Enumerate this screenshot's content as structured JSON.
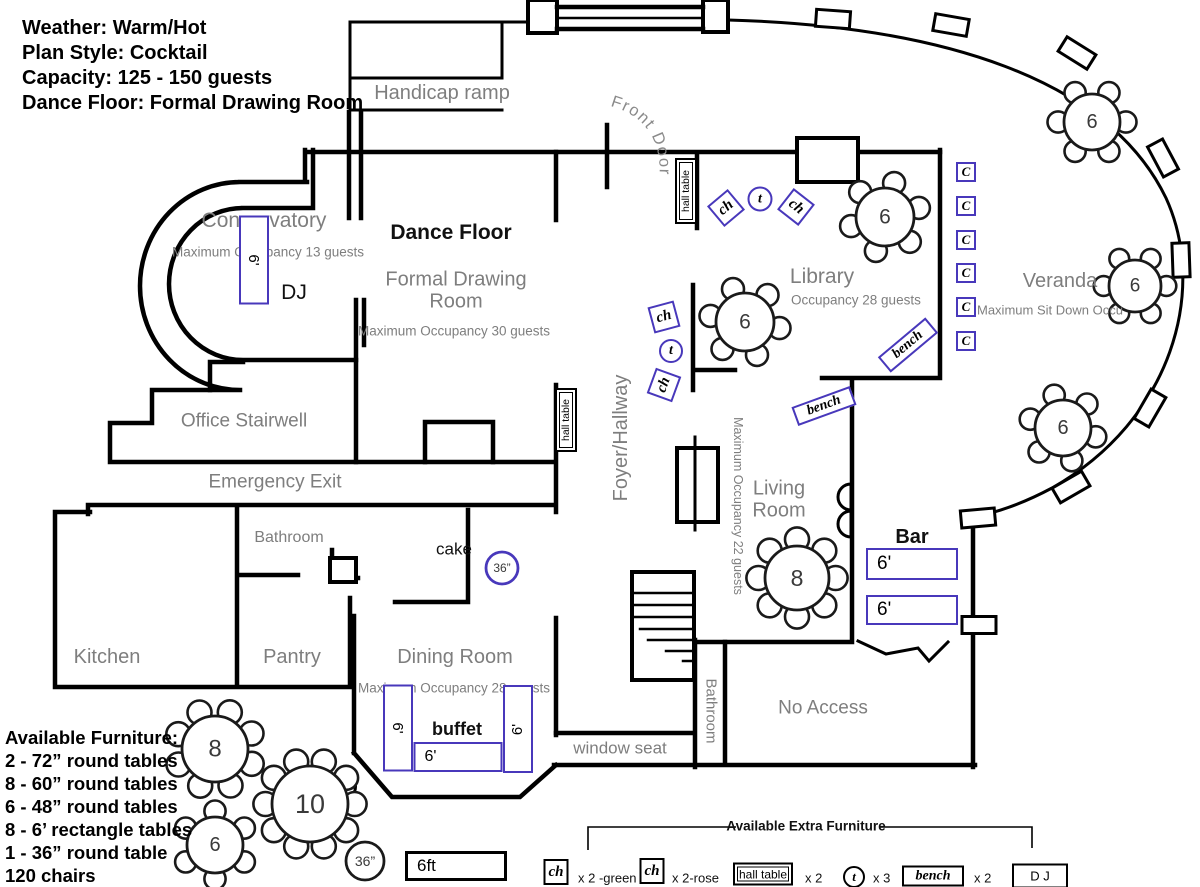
{
  "colors": {
    "furniture_accent": "#4838bb",
    "wall": "#000000",
    "room_label": "#7e7e7e"
  },
  "info_panel": {
    "lines": [
      "Weather: Warm/Hot",
      "Plan Style: Cocktail",
      "Capacity: 125 - 150 guests",
      "Dance Floor: Formal Drawing Room"
    ]
  },
  "available_furniture": {
    "title": "Available Furniture:",
    "items": [
      "2 - 72” round tables",
      "8 - 60” round tables",
      "6 - 48” round tables",
      "8 - 6’ rectangle tables",
      "1 - 36” round table",
      "120 chairs"
    ]
  },
  "front_door": {
    "text": "Front Door"
  },
  "labels": [
    {
      "name": "handicap-ramp-label",
      "text": "Handicap ramp",
      "x": 442,
      "y": 93,
      "size": 20,
      "color": "gray"
    },
    {
      "name": "conservatory-label",
      "text": "Conservatory",
      "x": 264,
      "y": 221,
      "size": 21,
      "color": "gray"
    },
    {
      "name": "conservatory-occupancy",
      "text": "Maximum Occupancy 13 guests",
      "x": 268,
      "y": 252,
      "size": 13.5,
      "color": "gray"
    },
    {
      "name": "dance-floor-label",
      "text": "Dance Floor",
      "x": 451,
      "y": 233,
      "size": 21,
      "color": "black",
      "weight": 600
    },
    {
      "name": "formal-drawing-room-label",
      "text": "Formal Drawing\nRoom",
      "x": 456,
      "y": 291,
      "size": 20,
      "color": "gray",
      "w": 170
    },
    {
      "name": "fdr-occupancy",
      "text": "Maximum Occupancy  30 guests",
      "x": 454,
      "y": 331,
      "size": 13.5,
      "color": "gray"
    },
    {
      "name": "dj-label",
      "text": "DJ",
      "x": 294,
      "y": 293,
      "size": 21,
      "color": "black"
    },
    {
      "name": "office-stairwell-label",
      "text": "Office Stairwell",
      "x": 244,
      "y": 421,
      "size": 19,
      "color": "gray"
    },
    {
      "name": "emergency-exit-label",
      "text": "Emergency Exit",
      "x": 275,
      "y": 482,
      "size": 19,
      "color": "gray"
    },
    {
      "name": "bathroom-label",
      "text": "Bathroom",
      "x": 289,
      "y": 538,
      "size": 16,
      "color": "gray"
    },
    {
      "name": "cake-label",
      "text": "cake",
      "x": 454,
      "y": 549,
      "size": 17,
      "color": "black"
    },
    {
      "name": "kitchen-label",
      "text": "Kitchen",
      "x": 107,
      "y": 657,
      "size": 20,
      "color": "gray"
    },
    {
      "name": "pantry-label",
      "text": "Pantry",
      "x": 292,
      "y": 657,
      "size": 20,
      "color": "gray"
    },
    {
      "name": "dining-room-label",
      "text": "Dining Room",
      "x": 455,
      "y": 657,
      "size": 20,
      "color": "gray"
    },
    {
      "name": "dining-occupancy",
      "text": "Maximum Occupancy 28 guests",
      "x": 454,
      "y": 688,
      "size": 13.5,
      "color": "gray"
    },
    {
      "name": "buffet-label",
      "text": "buffet",
      "x": 457,
      "y": 729,
      "size": 18,
      "color": "black",
      "weight": 600
    },
    {
      "name": "window-seat-label",
      "text": "window seat",
      "x": 620,
      "y": 748,
      "size": 17,
      "color": "gray"
    },
    {
      "name": "foyer-hallway-label",
      "text": "Foyer/Hallway",
      "x": 621,
      "y": 438,
      "size": 20,
      "color": "gray",
      "rot": -90
    },
    {
      "name": "library-label",
      "text": "Library",
      "x": 822,
      "y": 277,
      "size": 21,
      "color": "gray"
    },
    {
      "name": "library-occupancy",
      "text": "Occupancy 28 guests",
      "x": 791,
      "y": 300,
      "size": 13.5,
      "color": "gray",
      "align": "left"
    },
    {
      "name": "living-room-label",
      "text": "Living\nRoom",
      "x": 779,
      "y": 500,
      "size": 20,
      "color": "gray",
      "w": 90
    },
    {
      "name": "living-occupancy",
      "text": "Maximum Occupancy 22 guests",
      "x": 738,
      "y": 506,
      "size": 12.5,
      "color": "gray",
      "rot": 90
    },
    {
      "name": "veranda-label",
      "text": "Veranda",
      "x": 1060,
      "y": 281,
      "size": 20,
      "color": "gray"
    },
    {
      "name": "veranda-occupancy",
      "text": "Maximum Sit Down Occu",
      "x": 977,
      "y": 311,
      "size": 13,
      "color": "gray",
      "align": "left"
    },
    {
      "name": "bathroom-2-label",
      "text": "Bathroom",
      "x": 710,
      "y": 711,
      "size": 15,
      "color": "gray",
      "rot": 90
    },
    {
      "name": "no-access-label",
      "text": "No Access",
      "x": 823,
      "y": 708,
      "size": 19,
      "color": "gray"
    },
    {
      "name": "bar-label",
      "text": "Bar",
      "x": 912,
      "y": 537,
      "size": 20,
      "color": "black",
      "weight": 600
    },
    {
      "name": "extra-furniture-title",
      "text": "Available Extra Furniture",
      "x": 806,
      "y": 826,
      "size": 13.5,
      "color": "black",
      "weight": 600
    },
    {
      "name": "legend-ch-green-qty",
      "text": "x 2 -green",
      "x": 578,
      "y": 879,
      "size": 13,
      "color": "black",
      "align": "left"
    },
    {
      "name": "legend-ch-rose-qty",
      "text": "x 2-rose",
      "x": 672,
      "y": 879,
      "size": 13,
      "color": "black",
      "align": "left"
    },
    {
      "name": "legend-hall-table-qty",
      "text": "x 2",
      "x": 805,
      "y": 879,
      "size": 13,
      "color": "black",
      "align": "left"
    },
    {
      "name": "legend-t-qty",
      "text": "x 3",
      "x": 873,
      "y": 879,
      "size": 13,
      "color": "black",
      "align": "left"
    },
    {
      "name": "legend-bench-qty",
      "text": "x 2",
      "x": 974,
      "y": 879,
      "size": 13,
      "color": "black",
      "align": "left"
    }
  ],
  "furniture": [
    {
      "name": "conservatory-6ft-table",
      "kind": "rect",
      "x": 254,
      "y": 260,
      "w": 30,
      "h": 89,
      "label": "6'",
      "lrot": 90,
      "fs": 15
    },
    {
      "name": "hall-table-1",
      "kind": "hall",
      "x": 686,
      "y": 191,
      "w": 22,
      "h": 66,
      "label": "hall table",
      "lrot": -90,
      "fs": 10.5
    },
    {
      "name": "hall-table-2",
      "kind": "hall",
      "x": 566,
      "y": 420,
      "w": 22,
      "h": 64,
      "label": "hall table",
      "lrot": -90,
      "fs": 10.5
    },
    {
      "name": "chair-ch-1",
      "kind": "rect",
      "x": 726,
      "y": 208,
      "w": 27,
      "h": 27,
      "rot": -40,
      "label": "ch",
      "fs": 15,
      "serif": 1
    },
    {
      "name": "table-t-1",
      "kind": "circle",
      "x": 760,
      "y": 199,
      "w": 25,
      "h": 25,
      "label": "t",
      "fs": 14,
      "serif": 1
    },
    {
      "name": "chair-ch-2",
      "kind": "rect",
      "x": 796,
      "y": 207,
      "w": 27,
      "h": 27,
      "rot": 38,
      "label": "ch",
      "fs": 15,
      "serif": 1
    },
    {
      "name": "chair-ch-3",
      "kind": "rect",
      "x": 664,
      "y": 317,
      "w": 27,
      "h": 27,
      "rot": -15,
      "label": "ch",
      "fs": 15,
      "serif": 1
    },
    {
      "name": "table-t-2",
      "kind": "circle",
      "x": 671,
      "y": 351,
      "w": 24,
      "h": 24,
      "label": "t",
      "fs": 14,
      "serif": 1
    },
    {
      "name": "chair-ch-4",
      "kind": "rect",
      "x": 664,
      "y": 385,
      "w": 27,
      "h": 27,
      "rot": -70,
      "label": "ch",
      "fs": 15,
      "serif": 1
    },
    {
      "name": "chair-c-1",
      "kind": "rect",
      "x": 966,
      "y": 172,
      "w": 20,
      "h": 20,
      "label": "C",
      "fs": 13,
      "serif": 1
    },
    {
      "name": "chair-c-2",
      "kind": "rect",
      "x": 966,
      "y": 206,
      "w": 20,
      "h": 20,
      "label": "C",
      "fs": 13,
      "serif": 1
    },
    {
      "name": "chair-c-3",
      "kind": "rect",
      "x": 966,
      "y": 240,
      "w": 20,
      "h": 20,
      "label": "C",
      "fs": 13,
      "serif": 1
    },
    {
      "name": "chair-c-4",
      "kind": "rect",
      "x": 966,
      "y": 273,
      "w": 20,
      "h": 20,
      "label": "C",
      "fs": 13,
      "serif": 1
    },
    {
      "name": "chair-c-5",
      "kind": "rect",
      "x": 966,
      "y": 307,
      "w": 20,
      "h": 20,
      "label": "C",
      "fs": 13,
      "serif": 1
    },
    {
      "name": "chair-c-6",
      "kind": "rect",
      "x": 966,
      "y": 341,
      "w": 20,
      "h": 20,
      "label": "C",
      "fs": 13,
      "serif": 1
    },
    {
      "name": "bench-1",
      "kind": "rect",
      "x": 908,
      "y": 345,
      "w": 62,
      "h": 20,
      "rot": -40,
      "label": "bench",
      "fs": 14,
      "serif": 1
    },
    {
      "name": "bench-2",
      "kind": "rect",
      "x": 824,
      "y": 406,
      "w": 62,
      "h": 20,
      "rot": -20,
      "label": "bench",
      "fs": 14,
      "serif": 1
    },
    {
      "name": "bar-table-1",
      "kind": "rect",
      "x": 912,
      "y": 564,
      "w": 92,
      "h": 32,
      "label": "6'",
      "fs": 19,
      "align": "left"
    },
    {
      "name": "bar-table-2",
      "kind": "rect",
      "x": 912,
      "y": 610,
      "w": 92,
      "h": 30,
      "label": "6'",
      "fs": 19,
      "align": "left"
    },
    {
      "name": "buffet-table-left",
      "kind": "rect",
      "x": 398,
      "y": 728,
      "w": 30,
      "h": 87,
      "label": "6'",
      "lrot": 90,
      "fs": 15
    },
    {
      "name": "buffet-table-bottom",
      "kind": "rect",
      "x": 458,
      "y": 757,
      "w": 89,
      "h": 30,
      "label": "6'",
      "fs": 16,
      "align": "left"
    },
    {
      "name": "buffet-table-right",
      "kind": "rect",
      "x": 518,
      "y": 729,
      "w": 30,
      "h": 88,
      "label": "6'",
      "lrot": -90,
      "fs": 15
    },
    {
      "name": "scale-box",
      "kind": "rect",
      "x": 456,
      "y": 866,
      "w": 102,
      "h": 30,
      "label": "6ft",
      "fs": 17,
      "border": "black",
      "align": "left",
      "bw": 3
    },
    {
      "name": "legend-ch-green",
      "kind": "rect",
      "x": 556,
      "y": 872,
      "w": 25,
      "h": 26,
      "label": "ch",
      "fs": 15,
      "serif": 1,
      "border": "black"
    },
    {
      "name": "legend-ch-rose",
      "kind": "rect",
      "x": 652,
      "y": 871,
      "w": 25,
      "h": 26,
      "label": "ch",
      "fs": 15,
      "serif": 1,
      "border": "black"
    },
    {
      "name": "legend-hall-table",
      "kind": "hall",
      "x": 763,
      "y": 874,
      "w": 60,
      "h": 23,
      "label": "hall table",
      "fs": 12
    },
    {
      "name": "legend-t",
      "kind": "circle",
      "x": 854,
      "y": 877,
      "w": 22,
      "h": 22,
      "label": "t",
      "fs": 13,
      "serif": 1,
      "border": "black"
    },
    {
      "name": "legend-bench",
      "kind": "rect",
      "x": 933,
      "y": 876,
      "w": 62,
      "h": 21,
      "label": "bench",
      "fs": 14,
      "serif": 1,
      "border": "black"
    },
    {
      "name": "legend-dj",
      "kind": "rect",
      "x": 1040,
      "y": 876,
      "w": 56,
      "h": 25,
      "label": "D J",
      "fs": 13,
      "border": "black"
    }
  ],
  "tables": [
    {
      "name": "round-table-topright",
      "cx": 1092,
      "cy": 122,
      "r": 28,
      "seats": 6,
      "label": "6"
    },
    {
      "name": "round-table-library-1",
      "cx": 885,
      "cy": 217,
      "r": 29,
      "seats": 6,
      "label": "6",
      "offset": -15
    },
    {
      "name": "round-table-library-2",
      "cx": 745,
      "cy": 322,
      "r": 29,
      "seats": 6,
      "label": "6",
      "offset": 10
    },
    {
      "name": "round-table-veranda-1",
      "cx": 1135,
      "cy": 286,
      "r": 26,
      "seats": 6,
      "label": "6"
    },
    {
      "name": "round-table-veranda-2",
      "cx": 1063,
      "cy": 428,
      "r": 28,
      "seats": 6,
      "label": "6",
      "offset": 15
    },
    {
      "name": "round-table-living",
      "cx": 797,
      "cy": 578,
      "r": 32,
      "seats": 8,
      "label": "8"
    },
    {
      "name": "round-table-avail-8",
      "cx": 215,
      "cy": 749,
      "r": 33,
      "seats": 8,
      "label": "8",
      "offset": 22
    },
    {
      "name": "round-table-avail-10",
      "cx": 310,
      "cy": 804,
      "r": 38,
      "seats": 10,
      "label": "10"
    },
    {
      "name": "round-table-avail-6",
      "cx": 215,
      "cy": 845,
      "r": 28,
      "seats": 6,
      "label": "6",
      "offset": 30
    },
    {
      "name": "cake-table-36",
      "cx": 502,
      "cy": 568,
      "r": 16,
      "seats": 0,
      "label": "36”",
      "color": "blue",
      "fs": 12
    },
    {
      "name": "round-table-36-avail",
      "cx": 365,
      "cy": 861,
      "r": 19,
      "seats": 0,
      "label": "36”",
      "fs": 14
    }
  ]
}
